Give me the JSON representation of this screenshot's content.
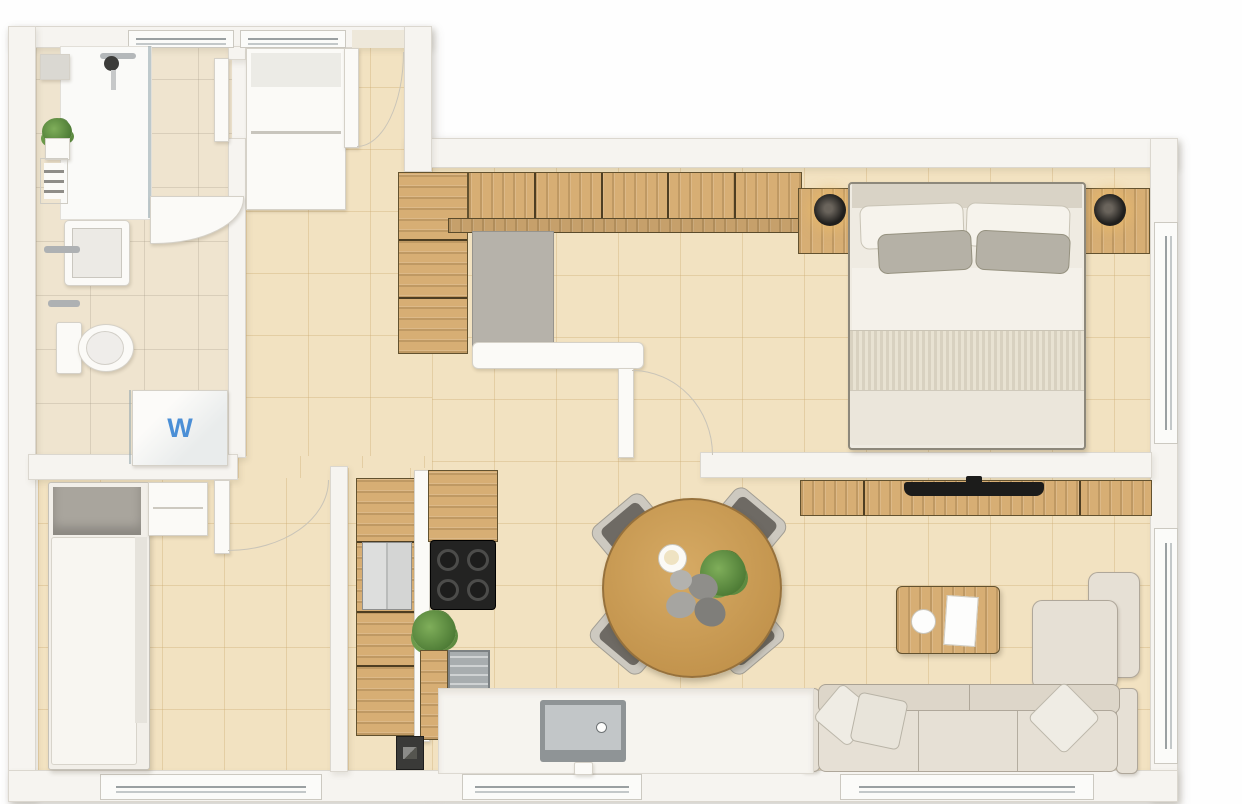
{
  "meta": {
    "type": "apartment-floor-plan",
    "view": "top-down-render",
    "style": "beige-wood"
  },
  "labels": {
    "washer": "W"
  },
  "colors": {
    "wall": "#f6f4f0",
    "wallBorder": "#dbd7cf",
    "floor": "#f2e2c1",
    "bathFloor": "#efe4cf",
    "wood": "#d7ae74",
    "fabric": "#e6e0d5",
    "accent": "#4b8fd6",
    "dark": "#2d2c2a"
  },
  "rooms": [
    {
      "name": "bathroom",
      "features": [
        "shower",
        "wall-shelf",
        "plant",
        "towel-radiator",
        "sink",
        "toilet",
        "washer"
      ]
    },
    {
      "name": "entry-hall",
      "features": [
        "closet",
        "entry-door",
        "wardrobe-row",
        "dressing-panel",
        "bench"
      ]
    },
    {
      "name": "bedroom",
      "features": [
        "double-bed",
        "nightstand-left",
        "nightstand-right",
        "lamps",
        "window"
      ]
    },
    {
      "name": "dining",
      "features": [
        "round-table",
        "four-chairs",
        "plant-centerpiece",
        "cup",
        "bowls"
      ]
    },
    {
      "name": "living-room",
      "features": [
        "tv-console",
        "tv",
        "coffee-table",
        "corner-sofa",
        "pillows",
        "windows"
      ]
    },
    {
      "name": "kitchen",
      "features": [
        "tall-cabinets",
        "fridge",
        "cooktop",
        "dishwasher",
        "plant",
        "counter-with-sink",
        "appliance"
      ]
    },
    {
      "name": "small-room",
      "features": [
        "single-bed",
        "nightstand",
        "door",
        "window"
      ]
    }
  ]
}
